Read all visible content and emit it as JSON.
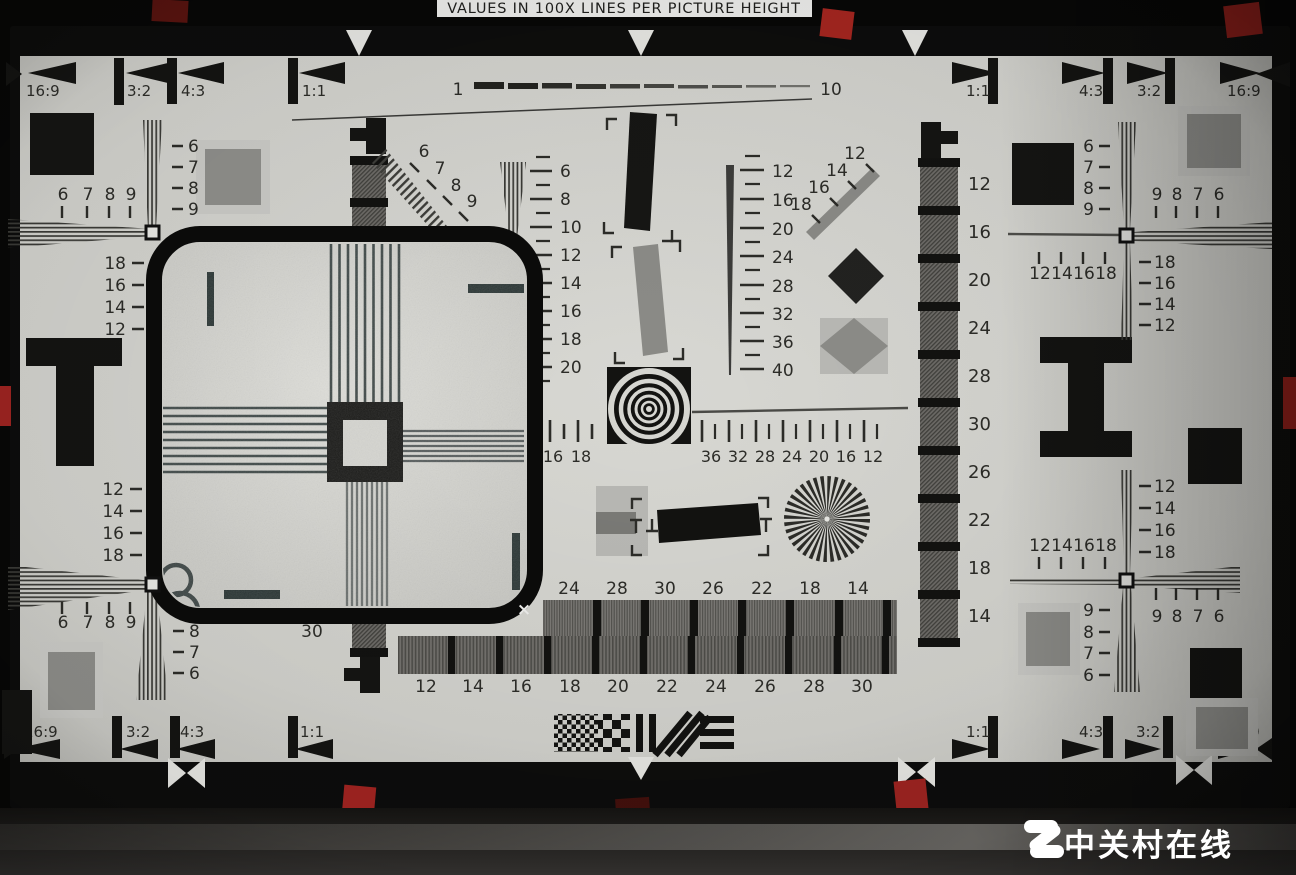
{
  "title_plate": "VALUES IN 100X LINES PER PICTURE HEIGHT",
  "ruler": {
    "start": "1",
    "end": "10"
  },
  "aspect": {
    "tl": [
      "16:9",
      "3:2",
      "4:3",
      "1:1"
    ],
    "tr": [
      "1:1",
      "4:3",
      "3:2",
      "16:9"
    ],
    "bl": [
      "16:9",
      "3:2",
      "4:3",
      "1:1"
    ],
    "br": [
      "1:1",
      "4:3",
      "3:2",
      "16:9"
    ]
  },
  "tl": {
    "row": [
      "6",
      "7",
      "8",
      "9"
    ],
    "col": [
      "6",
      "7",
      "8",
      "9"
    ],
    "side": [
      "18",
      "16",
      "14",
      "12"
    ]
  },
  "tr": {
    "col": [
      "6",
      "7",
      "8",
      "9"
    ],
    "row": [
      "9",
      "8",
      "7",
      "6"
    ],
    "ticks": [
      "12",
      "14",
      "16",
      "18"
    ],
    "side": [
      "18",
      "16",
      "14",
      "12"
    ]
  },
  "bl": {
    "side": [
      "12",
      "14",
      "16",
      "18"
    ],
    "row": [
      "6",
      "7",
      "8",
      "9"
    ],
    "col": [
      "8",
      "7",
      "6"
    ],
    "ladder_end": "30"
  },
  "br": {
    "side": [
      "12",
      "14",
      "16",
      "18"
    ],
    "ticks": [
      "12",
      "14",
      "16",
      "18"
    ],
    "col": [
      "9",
      "8",
      "7",
      "6"
    ],
    "row": [
      "9",
      "8",
      "7",
      "6"
    ]
  },
  "center": {
    "diag_l": [
      "6",
      "7",
      "8",
      "9"
    ],
    "vscale": [
      "6",
      "8",
      "10",
      "12",
      "14",
      "16",
      "18",
      "20"
    ],
    "wedge": [
      "12",
      "16",
      "20",
      "24",
      "28",
      "32",
      "36",
      "40"
    ],
    "diag_r": [
      "12",
      "14",
      "16",
      "18"
    ],
    "ruler_l": [
      "16",
      "18"
    ],
    "ruler_r": [
      "36",
      "32",
      "28",
      "24",
      "20",
      "16",
      "12"
    ],
    "ladder": [
      "12",
      "16",
      "20",
      "24",
      "28",
      "30",
      "26",
      "22",
      "18",
      "14"
    ],
    "steps_top": [
      "24",
      "28",
      "30",
      "26",
      "22",
      "18",
      "14"
    ],
    "steps_bottom": [
      "12",
      "14",
      "16",
      "18",
      "20",
      "22",
      "24",
      "26",
      "28",
      "30"
    ]
  },
  "magnifier": {
    "corner_mark": "×"
  },
  "watermark": {
    "brand": "中关村在线"
  },
  "colors": {
    "paper": "#d4d4d0",
    "ink": "#1c1c1a",
    "tape_red": "#942420",
    "watermark": "#ffffff"
  }
}
